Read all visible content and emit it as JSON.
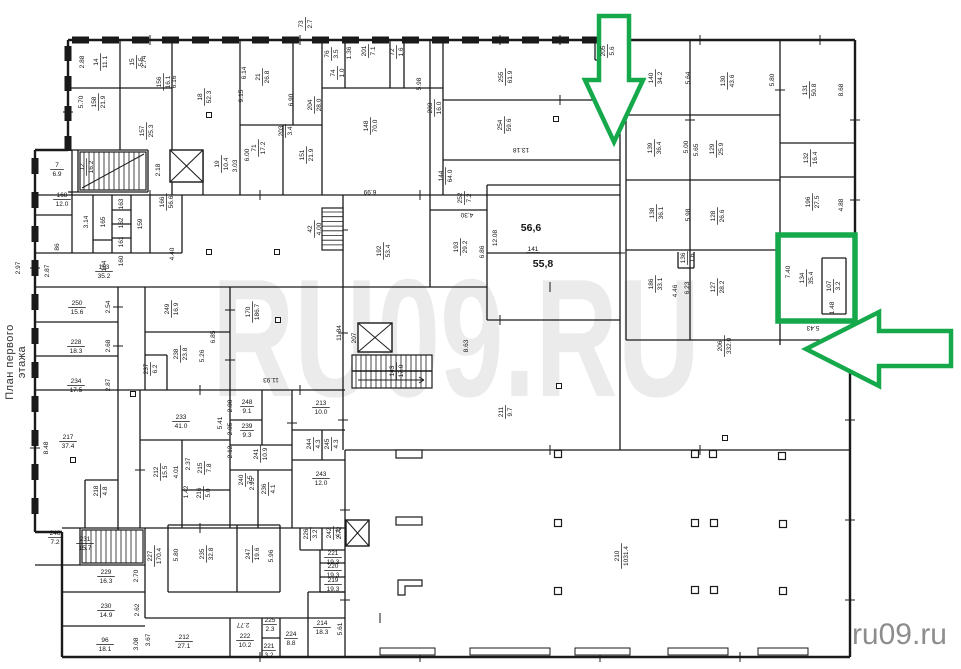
{
  "page": {
    "width": 961,
    "height": 669,
    "background": "#ffffff"
  },
  "caption": {
    "text": "План первого этажа"
  },
  "watermark": {
    "large": "RU09.RU",
    "large_color": "#ebebeb",
    "small": "ru09.ru",
    "small_color": "#8d8d8d"
  },
  "plan": {
    "wall_color": "#1a1a1a",
    "label_color": "#141414",
    "rooms": [
      {
        "n": "14",
        "a": "11.1",
        "x": 100,
        "y": 62
      },
      {
        "n": "15",
        "a": "5.5",
        "x": 136,
        "y": 62
      },
      {
        "n": "158",
        "a": "21.9",
        "x": 98,
        "y": 102
      },
      {
        "n": "156",
        "a": "16.1",
        "x": 163,
        "y": 82
      },
      {
        "n": "157",
        "a": "25.3",
        "x": 146,
        "y": 131
      },
      {
        "n": "18",
        "a": "52.3",
        "x": 204,
        "y": 97
      },
      {
        "n": "21",
        "a": "26.8",
        "x": 262,
        "y": 77
      },
      {
        "n": "73",
        "a": "2.7",
        "x": 305,
        "y": 24
      },
      {
        "n": "204",
        "a": "28.0",
        "x": 314,
        "y": 105
      },
      {
        "n": "203",
        "a": "3.4",
        "x": 285,
        "y": 131
      },
      {
        "n": "71",
        "a": "17.2",
        "x": 258,
        "y": 148
      },
      {
        "n": "151",
        "a": "21.9",
        "x": 306,
        "y": 155
      },
      {
        "n": "19",
        "a": "10.4",
        "x": 221,
        "y": 164
      },
      {
        "n": "12",
        "a": "16.2",
        "x": 86,
        "y": 167
      },
      {
        "n": "7",
        "a": "6.9",
        "x": 57,
        "y": 169,
        "r": 0
      },
      {
        "n": "168",
        "a": "12.0",
        "x": 62,
        "y": 199,
        "r": 0
      },
      {
        "n": "86",
        "a": "",
        "x": 57,
        "y": 247
      },
      {
        "n": "165",
        "a": "",
        "x": 103,
        "y": 222
      },
      {
        "n": "163",
        "a": "",
        "x": 121,
        "y": 204
      },
      {
        "n": "162",
        "a": "",
        "x": 121,
        "y": 223
      },
      {
        "n": "161",
        "a": "",
        "x": 121,
        "y": 242
      },
      {
        "n": "160",
        "a": "",
        "x": 121,
        "y": 261
      },
      {
        "n": "159",
        "a": "",
        "x": 140,
        "y": 224
      },
      {
        "n": "164",
        "a": "",
        "x": 104,
        "y": 266
      },
      {
        "n": "166",
        "a": "56.6",
        "x": 166,
        "y": 202
      },
      {
        "n": "153",
        "a": "35.2",
        "x": 104,
        "y": 271,
        "r": 0
      },
      {
        "n": "42",
        "a": "4.00",
        "x": 314,
        "y": 229
      },
      {
        "n": "192",
        "a": "53.4",
        "x": 383,
        "y": 251
      },
      {
        "n": "193",
        "a": "29.2",
        "x": 460,
        "y": 247
      },
      {
        "n": "252",
        "a": "7.2",
        "x": 464,
        "y": 198
      },
      {
        "n": "144",
        "a": "64.0",
        "x": 445,
        "y": 176
      },
      {
        "n": "148",
        "a": "70.0",
        "x": 370,
        "y": 126
      },
      {
        "n": "203",
        "a": "16.0",
        "x": 434,
        "y": 108
      },
      {
        "n": "255",
        "a": "61.9",
        "x": 505,
        "y": 77
      },
      {
        "n": "254",
        "a": "59.6",
        "x": 504,
        "y": 125
      },
      {
        "n": "201",
        "a": "7.1",
        "x": 368,
        "y": 51
      },
      {
        "n": "76",
        "a": "3.5",
        "x": 331,
        "y": 54
      },
      {
        "n": "74",
        "a": "1.0",
        "x": 337,
        "y": 73
      },
      {
        "n": "72",
        "a": "1.6",
        "x": 396,
        "y": 52
      },
      {
        "n": "205",
        "a": "5.6",
        "x": 607,
        "y": 51
      },
      {
        "n": "140",
        "a": "34.2",
        "x": 655,
        "y": 78
      },
      {
        "n": "130",
        "a": "43.6",
        "x": 727,
        "y": 81
      },
      {
        "n": "131",
        "a": "50.8",
        "x": 809,
        "y": 90
      },
      {
        "n": "139",
        "a": "36.4",
        "x": 654,
        "y": 148
      },
      {
        "n": "129",
        "a": "25.9",
        "x": 716,
        "y": 149
      },
      {
        "n": "138",
        "a": "36.1",
        "x": 656,
        "y": 213
      },
      {
        "n": "128",
        "a": "26.6",
        "x": 717,
        "y": 216
      },
      {
        "n": "186",
        "a": "33.1",
        "x": 655,
        "y": 284
      },
      {
        "n": "127",
        "a": "28.2",
        "x": 717,
        "y": 287
      },
      {
        "n": "136",
        "a": "1.6",
        "x": 687,
        "y": 258
      },
      {
        "n": "132",
        "a": "16.4",
        "x": 810,
        "y": 158
      },
      {
        "n": "196",
        "a": "27.5",
        "x": 812,
        "y": 202
      },
      {
        "n": "134",
        "a": "35.4",
        "x": 806,
        "y": 278
      },
      {
        "n": "107",
        "a": "3.2",
        "x": 833,
        "y": 286
      },
      {
        "n": "206",
        "a": "332.0",
        "x": 724,
        "y": 346
      },
      {
        "n": "141",
        "a": "",
        "x": 533,
        "y": 249,
        "r": 0,
        "u": 1
      },
      {
        "n": "211",
        "a": "9.7",
        "x": 505,
        "y": 412
      },
      {
        "n": "207",
        "a": "",
        "x": 354,
        "y": 338
      },
      {
        "n": "143",
        "a": "17.0",
        "x": 396,
        "y": 371
      },
      {
        "n": "170",
        "a": "186.7",
        "x": 252,
        "y": 312
      },
      {
        "n": "250",
        "a": "15.6",
        "x": 77,
        "y": 307,
        "r": 0
      },
      {
        "n": "228",
        "a": "18.3",
        "x": 76,
        "y": 346,
        "r": 0
      },
      {
        "n": "234",
        "a": "17.5",
        "x": 76,
        "y": 385,
        "r": 0
      },
      {
        "n": "217",
        "a": "37.4",
        "x": 68,
        "y": 441,
        "r": 0
      },
      {
        "n": "218",
        "a": "4.8",
        "x": 100,
        "y": 491
      },
      {
        "n": "249",
        "a": "16.9",
        "x": 171,
        "y": 309
      },
      {
        "n": "238",
        "a": "23.8",
        "x": 180,
        "y": 354
      },
      {
        "n": "237",
        "a": "6.2",
        "x": 150,
        "y": 369
      },
      {
        "n": "233",
        "a": "41.0",
        "x": 181,
        "y": 421,
        "r": 0
      },
      {
        "n": "248",
        "a": "9.1",
        "x": 247,
        "y": 406,
        "r": 0
      },
      {
        "n": "239",
        "a": "9.3",
        "x": 247,
        "y": 430,
        "r": 0
      },
      {
        "n": "241",
        "a": "10.9",
        "x": 260,
        "y": 454
      },
      {
        "n": "240",
        "a": "7.5",
        "x": 245,
        "y": 480
      },
      {
        "n": "236",
        "a": "4.1",
        "x": 268,
        "y": 489
      },
      {
        "n": "212",
        "a": "15.5",
        "x": 160,
        "y": 472
      },
      {
        "n": "215",
        "a": "7.8",
        "x": 204,
        "y": 468
      },
      {
        "n": "216",
        "a": "5.0",
        "x": 203,
        "y": 493
      },
      {
        "n": "213",
        "a": "10.0",
        "x": 321,
        "y": 407,
        "r": 0
      },
      {
        "n": "244",
        "a": "4.3",
        "x": 313,
        "y": 444
      },
      {
        "n": "245",
        "a": "4.3",
        "x": 331,
        "y": 444
      },
      {
        "n": "243",
        "a": "12.0",
        "x": 321,
        "y": 478,
        "r": 0
      },
      {
        "n": "242",
        "a": "4.1",
        "x": 333,
        "y": 533
      },
      {
        "n": "226",
        "a": "3.2",
        "x": 310,
        "y": 534
      },
      {
        "n": "246",
        "a": "7.2",
        "x": 55,
        "y": 537,
        "r": 0
      },
      {
        "n": "231",
        "a": "15.7",
        "x": 85,
        "y": 543,
        "r": 0
      },
      {
        "n": "229",
        "a": "16.3",
        "x": 106,
        "y": 576,
        "r": 0
      },
      {
        "n": "230",
        "a": "14.9",
        "x": 106,
        "y": 610,
        "r": 0
      },
      {
        "n": "96",
        "a": "18.1",
        "x": 105,
        "y": 644,
        "r": 0
      },
      {
        "n": "227",
        "a": "170.4",
        "x": 154,
        "y": 556
      },
      {
        "n": "235",
        "a": "32.8",
        "x": 206,
        "y": 554
      },
      {
        "n": "247",
        "a": "19.6",
        "x": 252,
        "y": 554
      },
      {
        "n": "212",
        "a": "27.1",
        "x": 184,
        "y": 641,
        "r": 0
      },
      {
        "n": "222",
        "a": "10.2",
        "x": 245,
        "y": 640,
        "r": 0
      },
      {
        "n": "225",
        "a": "2.3",
        "x": 270,
        "y": 624,
        "r": 0
      },
      {
        "n": "221",
        "a": "3.2",
        "x": 269,
        "y": 650,
        "r": 0
      },
      {
        "n": "224",
        "a": "8.8",
        "x": 291,
        "y": 638,
        "r": 0
      },
      {
        "n": "214",
        "a": "18.3",
        "x": 322,
        "y": 627,
        "r": 0
      },
      {
        "n": "221",
        "a": "19.3",
        "x": 333,
        "y": 557,
        "r": 0
      },
      {
        "n": "220",
        "a": "19.3",
        "x": 333,
        "y": 570,
        "r": 0
      },
      {
        "n": "219",
        "a": "19.3",
        "x": 333,
        "y": 584,
        "r": 0
      },
      {
        "n": "210",
        "a": "1031.4",
        "x": 621,
        "y": 556
      }
    ],
    "dims": [
      {
        "t": "2.88",
        "x": 84,
        "y": 62
      },
      {
        "t": "2.74",
        "x": 146,
        "y": 62
      },
      {
        "t": "5.70",
        "x": 83,
        "y": 102
      },
      {
        "t": "6.16",
        "x": 176,
        "y": 82
      },
      {
        "t": "6.14",
        "x": 246,
        "y": 73
      },
      {
        "t": "9.15",
        "x": 243,
        "y": 96
      },
      {
        "t": "6.90",
        "x": 293,
        "y": 100
      },
      {
        "t": "2.18",
        "x": 160,
        "y": 170
      },
      {
        "t": "3.03",
        "x": 237,
        "y": 166
      },
      {
        "t": "6.00",
        "x": 249,
        "y": 155
      },
      {
        "t": "1.36",
        "x": 351,
        "y": 53
      },
      {
        "t": "5.98",
        "x": 421,
        "y": 84
      },
      {
        "t": "13.18",
        "x": 521,
        "y": 148,
        "r": 180
      },
      {
        "t": "6.99",
        "x": 370,
        "y": 190,
        "r": 180
      },
      {
        "t": "4.30",
        "x": 467,
        "y": 213,
        "r": 180
      },
      {
        "t": "12.08",
        "x": 497,
        "y": 238
      },
      {
        "t": "6.86",
        "x": 484,
        "y": 252
      },
      {
        "t": "5.64",
        "x": 690,
        "y": 78
      },
      {
        "t": "5.80",
        "x": 774,
        "y": 80
      },
      {
        "t": "8.68",
        "x": 843,
        "y": 90
      },
      {
        "t": "5.00",
        "x": 688,
        "y": 147
      },
      {
        "t": "5.65",
        "x": 698,
        "y": 150
      },
      {
        "t": "5.98",
        "x": 690,
        "y": 215
      },
      {
        "t": "4.46",
        "x": 677,
        "y": 291
      },
      {
        "t": "6.23",
        "x": 689,
        "y": 288
      },
      {
        "t": "4.88",
        "x": 843,
        "y": 205
      },
      {
        "t": "7.40",
        "x": 790,
        "y": 272
      },
      {
        "t": "1.48",
        "x": 834,
        "y": 308
      },
      {
        "t": "5.43",
        "x": 813,
        "y": 326,
        "r": 180
      },
      {
        "t": "4.40",
        "x": 174,
        "y": 254
      },
      {
        "t": "2.87",
        "x": 49,
        "y": 271
      },
      {
        "t": "2.97",
        "x": 20,
        "y": 268
      },
      {
        "t": "3.14",
        "x": 88,
        "y": 222
      },
      {
        "t": "11.84",
        "x": 341,
        "y": 333
      },
      {
        "t": "8.63",
        "x": 468,
        "y": 346
      },
      {
        "t": "11.93",
        "x": 271,
        "y": 378,
        "r": 180
      },
      {
        "t": "2.54",
        "x": 110,
        "y": 307
      },
      {
        "t": "2.68",
        "x": 110,
        "y": 346
      },
      {
        "t": "2.87",
        "x": 110,
        "y": 385
      },
      {
        "t": "8.48",
        "x": 48,
        "y": 448
      },
      {
        "t": "6.85",
        "x": 215,
        "y": 337
      },
      {
        "t": "5.26",
        "x": 204,
        "y": 356
      },
      {
        "t": "2.00",
        "x": 232,
        "y": 406
      },
      {
        "t": "2.05",
        "x": 232,
        "y": 429
      },
      {
        "t": "5.41",
        "x": 222,
        "y": 423
      },
      {
        "t": "2.12",
        "x": 232,
        "y": 452
      },
      {
        "t": "2.95",
        "x": 254,
        "y": 484
      },
      {
        "t": "4.01",
        "x": 178,
        "y": 472
      },
      {
        "t": "2.37",
        "x": 190,
        "y": 464
      },
      {
        "t": "1.42",
        "x": 188,
        "y": 492
      },
      {
        "t": "2.70",
        "x": 138,
        "y": 576
      },
      {
        "t": "2.62",
        "x": 139,
        "y": 610
      },
      {
        "t": "3.08",
        "x": 138,
        "y": 644
      },
      {
        "t": "3.67",
        "x": 150,
        "y": 640
      },
      {
        "t": "5.80",
        "x": 178,
        "y": 555
      },
      {
        "t": "5.96",
        "x": 273,
        "y": 556
      },
      {
        "t": "2.77",
        "x": 243,
        "y": 623,
        "r": 180
      },
      {
        "t": "5.61",
        "x": 342,
        "y": 629
      },
      {
        "t": "2.72",
        "x": 341,
        "y": 533
      }
    ],
    "bold_areas": [
      {
        "t": "56,6",
        "x": 531,
        "y": 231
      },
      {
        "t": "55,8",
        "x": 543,
        "y": 267
      }
    ]
  },
  "annotations": {
    "color": "#15a94c",
    "items": [
      {
        "id": "highlight-arrow-down",
        "shape": "arrow",
        "points": [
          [
            599,
            16
          ],
          [
            629,
            16
          ],
          [
            629,
            80
          ],
          [
            643,
            80
          ],
          [
            614,
            142
          ],
          [
            585,
            80
          ],
          [
            599,
            80
          ]
        ]
      },
      {
        "id": "highlight-arrow-left",
        "shape": "arrow",
        "points": [
          [
            806,
            349
          ],
          [
            879,
            312
          ],
          [
            879,
            331
          ],
          [
            951,
            331
          ],
          [
            951,
            366
          ],
          [
            879,
            366
          ],
          [
            879,
            386
          ]
        ]
      },
      {
        "id": "highlight-box",
        "shape": "rect",
        "x": 778,
        "y": 235,
        "w": 77,
        "h": 86
      }
    ]
  }
}
